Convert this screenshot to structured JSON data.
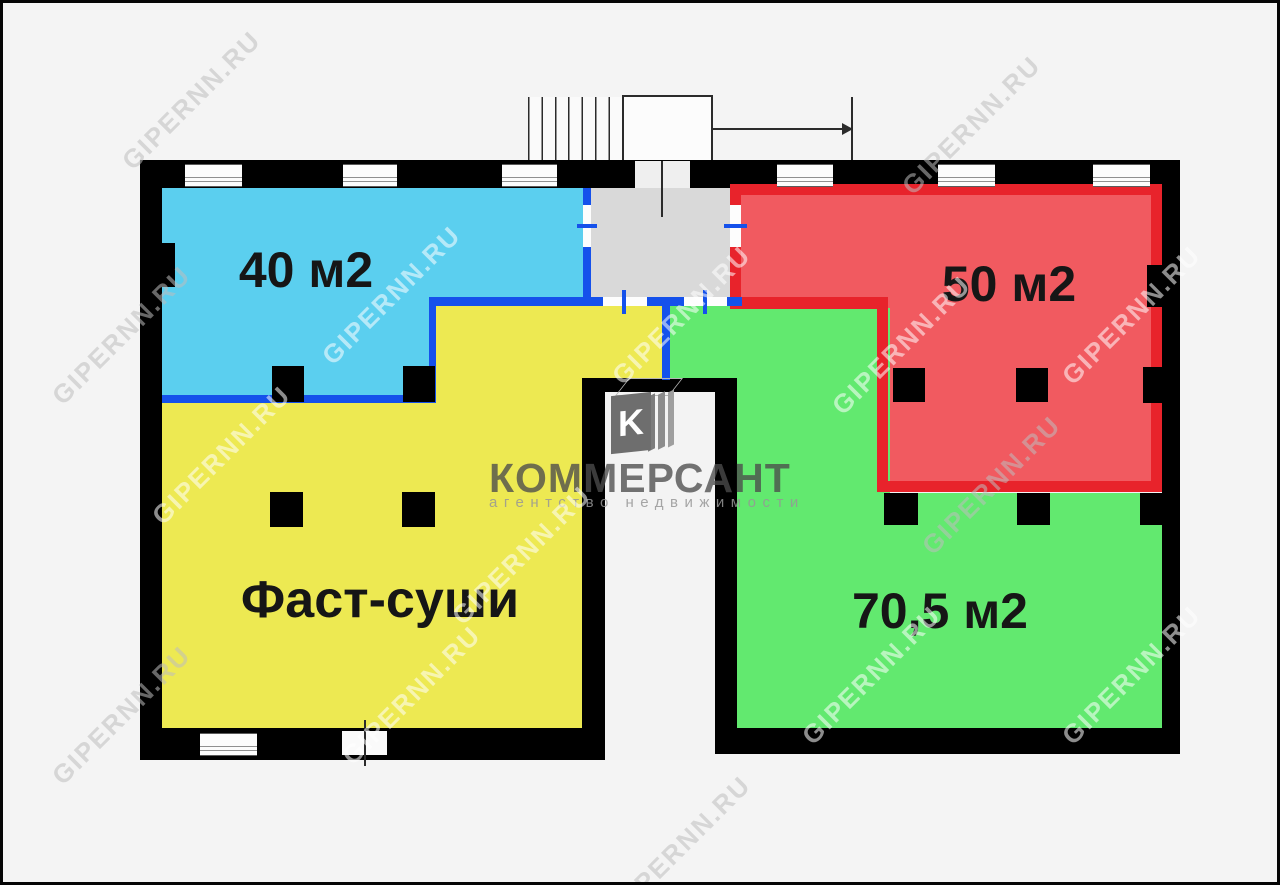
{
  "plan": {
    "rooms": [
      {
        "id": "blue",
        "label": "40 м2"
      },
      {
        "id": "red",
        "label": "50 м2"
      },
      {
        "id": "yellow",
        "label": "Фаст-суши"
      },
      {
        "id": "green",
        "label": "70,5 м2"
      }
    ]
  },
  "logo": {
    "name": "КОММЕРСАНТ",
    "tagline": "агентство недвижимости",
    "monogram": "K"
  },
  "watermark": {
    "text": "GIPERNN.RU"
  },
  "colors": {
    "bg": "#F4F4F4",
    "wall": "#000000",
    "blue_fill": "#5BCFEF",
    "blue_wall": "#1551EB",
    "yellow_fill": "#EDE952",
    "green_fill": "#62E96F",
    "red_fill": "#F15A60",
    "red_wall": "#E8232B",
    "vestibule": "#D9D9D9",
    "shaft": "#F3F3F3",
    "label": "#161616"
  }
}
